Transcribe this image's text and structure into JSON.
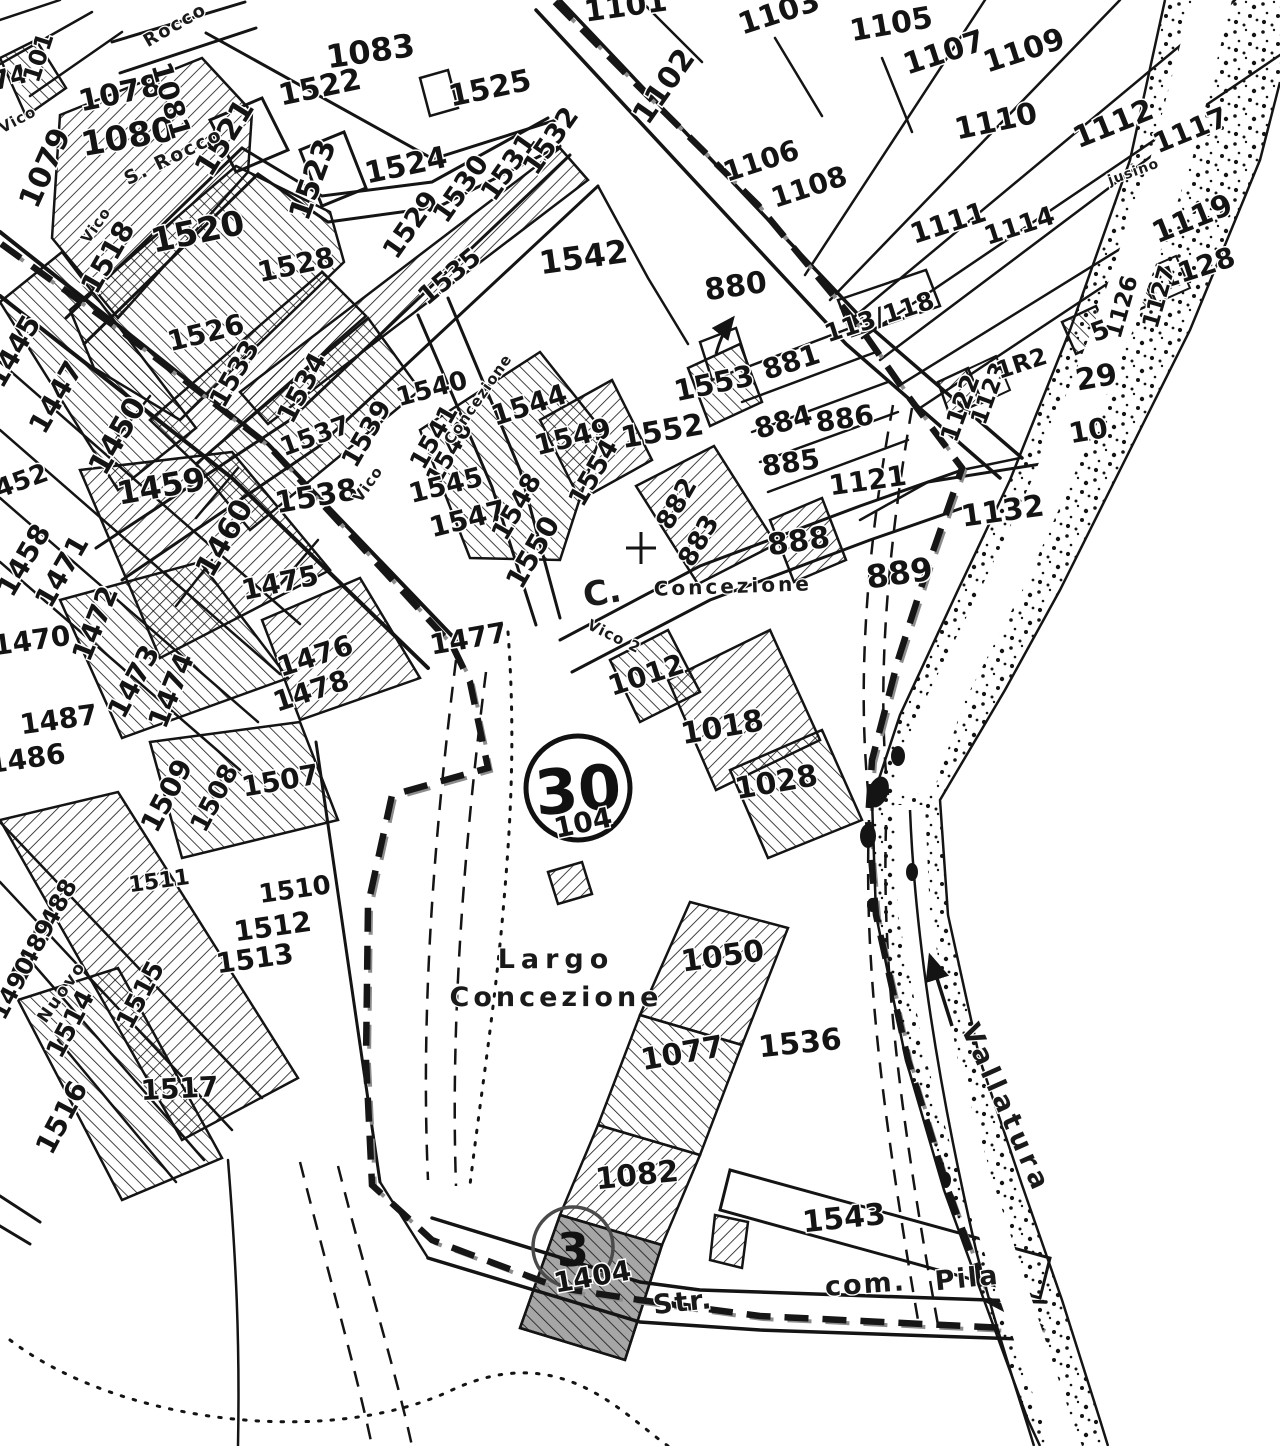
{
  "map": {
    "title": "Cadastral map sheet",
    "sheet": {
      "circle_number": "30",
      "sub_label": "104",
      "detail_circle_number": "3"
    },
    "colors": {
      "ink": "#141414",
      "paper": "#ffffff",
      "shade": "#a6a6a6",
      "scan_gray": "#8c8c8c"
    },
    "icons": [
      {
        "name": "flow-arrow-icon",
        "meaning": "stream flow direction"
      },
      {
        "name": "reference-arrow-icon",
        "meaning": "points label 880 to its parcel"
      },
      {
        "name": "church-cross-icon",
        "meaning": "church of the Concezione"
      }
    ],
    "parcel_labels": [
      {
        "t": "74",
        "x": 12,
        "y": 86,
        "r": -15,
        "s": 26
      },
      {
        "t": "101",
        "x": 46,
        "y": 60,
        "r": -72,
        "s": 24
      },
      {
        "t": "1079",
        "x": 54,
        "y": 172,
        "r": -66,
        "s": 30
      },
      {
        "t": "1078",
        "x": 122,
        "y": 103,
        "r": -12,
        "s": 30
      },
      {
        "t": "1080",
        "x": 130,
        "y": 148,
        "r": -10,
        "s": 34
      },
      {
        "t": "1081",
        "x": 162,
        "y": 103,
        "r": 74,
        "s": 28
      },
      {
        "t": "1083",
        "x": 372,
        "y": 62,
        "r": -8,
        "s": 32
      },
      {
        "t": "1522",
        "x": 322,
        "y": 97,
        "r": -12,
        "s": 30
      },
      {
        "t": "1525",
        "x": 492,
        "y": 98,
        "r": -12,
        "s": 30
      },
      {
        "t": "1521",
        "x": 233,
        "y": 143,
        "r": -58,
        "s": 30
      },
      {
        "t": "1523",
        "x": 322,
        "y": 183,
        "r": -70,
        "s": 30
      },
      {
        "t": "1524",
        "x": 408,
        "y": 175,
        "r": -12,
        "s": 30
      },
      {
        "t": "1520",
        "x": 200,
        "y": 243,
        "r": -12,
        "s": 34
      },
      {
        "t": "1518",
        "x": 116,
        "y": 262,
        "r": -60,
        "s": 28
      },
      {
        "t": "1528",
        "x": 298,
        "y": 274,
        "r": -12,
        "s": 28
      },
      {
        "t": "1529",
        "x": 418,
        "y": 230,
        "r": -55,
        "s": 27
      },
      {
        "t": "1530",
        "x": 468,
        "y": 194,
        "r": -55,
        "s": 27
      },
      {
        "t": "1531",
        "x": 516,
        "y": 172,
        "r": -55,
        "s": 27
      },
      {
        "t": "1532",
        "x": 558,
        "y": 146,
        "r": -55,
        "s": 27
      },
      {
        "t": "1535",
        "x": 455,
        "y": 283,
        "r": -40,
        "s": 26
      },
      {
        "t": "1526",
        "x": 208,
        "y": 342,
        "r": -14,
        "s": 28
      },
      {
        "t": "1533",
        "x": 242,
        "y": 378,
        "r": -60,
        "s": 26
      },
      {
        "t": "1534",
        "x": 310,
        "y": 392,
        "r": -62,
        "s": 27
      },
      {
        "t": "1537",
        "x": 318,
        "y": 444,
        "r": -20,
        "s": 26
      },
      {
        "t": "1539",
        "x": 374,
        "y": 438,
        "r": -60,
        "s": 26
      },
      {
        "t": "1540",
        "x": 434,
        "y": 397,
        "r": -15,
        "s": 26
      },
      {
        "t": "1541",
        "x": 441,
        "y": 441,
        "r": -60,
        "s": 25
      },
      {
        "t": "1538",
        "x": 318,
        "y": 506,
        "r": -10,
        "s": 30
      },
      {
        "t": "1542",
        "x": 585,
        "y": 268,
        "r": -8,
        "s": 32
      },
      {
        "t": "1544",
        "x": 532,
        "y": 414,
        "r": -18,
        "s": 28
      },
      {
        "t": "1546",
        "x": 456,
        "y": 457,
        "r": -60,
        "s": 24
      },
      {
        "t": "1545",
        "x": 448,
        "y": 494,
        "r": -14,
        "s": 27
      },
      {
        "t": "1547",
        "x": 470,
        "y": 528,
        "r": -14,
        "s": 28
      },
      {
        "t": "1548",
        "x": 524,
        "y": 511,
        "r": -60,
        "s": 26
      },
      {
        "t": "1550",
        "x": 541,
        "y": 557,
        "r": -60,
        "s": 28
      },
      {
        "t": "1549",
        "x": 575,
        "y": 446,
        "r": -14,
        "s": 28
      },
      {
        "t": "1554",
        "x": 601,
        "y": 477,
        "r": -60,
        "s": 26
      },
      {
        "t": "1552",
        "x": 664,
        "y": 441,
        "r": -10,
        "s": 30
      },
      {
        "t": "1553",
        "x": 716,
        "y": 393,
        "r": -12,
        "s": 29
      },
      {
        "t": "880",
        "x": 737,
        "y": 296,
        "r": -8,
        "s": 30
      },
      {
        "t": "881",
        "x": 794,
        "y": 371,
        "r": -18,
        "s": 28
      },
      {
        "t": "884",
        "x": 786,
        "y": 431,
        "r": -16,
        "s": 28
      },
      {
        "t": "885",
        "x": 792,
        "y": 472,
        "r": -8,
        "s": 28
      },
      {
        "t": "886",
        "x": 846,
        "y": 428,
        "r": -8,
        "s": 28
      },
      {
        "t": "882",
        "x": 684,
        "y": 508,
        "r": -60,
        "s": 26
      },
      {
        "t": "883",
        "x": 706,
        "y": 545,
        "r": -60,
        "s": 26
      },
      {
        "t": "888",
        "x": 800,
        "y": 551,
        "r": -8,
        "s": 30
      },
      {
        "t": "889",
        "x": 901,
        "y": 584,
        "r": -8,
        "s": 32
      },
      {
        "t": "1121",
        "x": 869,
        "y": 490,
        "r": -8,
        "s": 28
      },
      {
        "t": "1122",
        "x": 968,
        "y": 411,
        "r": -70,
        "s": 25
      },
      {
        "t": "1123",
        "x": 996,
        "y": 396,
        "r": -70,
        "s": 23
      },
      {
        "t": "1132",
        "x": 1004,
        "y": 521,
        "r": -8,
        "s": 30
      },
      {
        "t": "1101",
        "x": 627,
        "y": 16,
        "r": -8,
        "s": 30
      },
      {
        "t": "1102",
        "x": 672,
        "y": 92,
        "r": -55,
        "s": 30
      },
      {
        "t": "1103",
        "x": 782,
        "y": 22,
        "r": -18,
        "s": 30
      },
      {
        "t": "1105",
        "x": 893,
        "y": 34,
        "r": -10,
        "s": 30
      },
      {
        "t": "1106",
        "x": 764,
        "y": 170,
        "r": -18,
        "s": 28
      },
      {
        "t": "1108",
        "x": 812,
        "y": 196,
        "r": -18,
        "s": 28
      },
      {
        "t": "1107",
        "x": 947,
        "y": 62,
        "r": -18,
        "s": 30
      },
      {
        "t": "1109",
        "x": 1027,
        "y": 60,
        "r": -18,
        "s": 30
      },
      {
        "t": "1110",
        "x": 998,
        "y": 131,
        "r": -12,
        "s": 30
      },
      {
        "t": "1112",
        "x": 1117,
        "y": 133,
        "r": -22,
        "s": 30
      },
      {
        "t": "1117",
        "x": 1194,
        "y": 139,
        "r": -22,
        "s": 28
      },
      {
        "t": "1111",
        "x": 951,
        "y": 232,
        "r": -18,
        "s": 28
      },
      {
        "t": "1114",
        "x": 1022,
        "y": 234,
        "r": -18,
        "s": 26
      },
      {
        "t": "1119",
        "x": 1196,
        "y": 228,
        "r": -22,
        "s": 30
      },
      {
        "t": "1128",
        "x": 1200,
        "y": 277,
        "r": -18,
        "s": 28
      },
      {
        "t": "1126",
        "x": 1129,
        "y": 309,
        "r": -74,
        "s": 23
      },
      {
        "t": "1127",
        "x": 1166,
        "y": 299,
        "r": -74,
        "s": 23
      },
      {
        "t": "5",
        "x": 1103,
        "y": 339,
        "r": -20,
        "s": 26
      },
      {
        "t": "1R2",
        "x": 1024,
        "y": 371,
        "r": -18,
        "s": 24
      },
      {
        "t": "29",
        "x": 1098,
        "y": 387,
        "r": -10,
        "s": 30
      },
      {
        "t": "10",
        "x": 1090,
        "y": 440,
        "r": -10,
        "s": 28
      },
      {
        "t": "113/118",
        "x": 882,
        "y": 325,
        "r": -18,
        "s": 25
      },
      {
        "t": "1445",
        "x": 22,
        "y": 356,
        "r": -60,
        "s": 28
      },
      {
        "t": "1447",
        "x": 64,
        "y": 402,
        "r": -60,
        "s": 28
      },
      {
        "t": "1450",
        "x": 126,
        "y": 441,
        "r": -60,
        "s": 30
      },
      {
        "t": "1452",
        "x": 16,
        "y": 492,
        "r": -20,
        "s": 26
      },
      {
        "t": "1459",
        "x": 163,
        "y": 497,
        "r": -10,
        "s": 32
      },
      {
        "t": "1460",
        "x": 233,
        "y": 543,
        "r": -60,
        "s": 30
      },
      {
        "t": "1458",
        "x": 32,
        "y": 565,
        "r": -60,
        "s": 28
      },
      {
        "t": "1471",
        "x": 70,
        "y": 576,
        "r": -60,
        "s": 28
      },
      {
        "t": "1472",
        "x": 104,
        "y": 627,
        "r": -68,
        "s": 28
      },
      {
        "t": "1470",
        "x": 33,
        "y": 650,
        "r": -8,
        "s": 28
      },
      {
        "t": "1473",
        "x": 142,
        "y": 686,
        "r": -62,
        "s": 28
      },
      {
        "t": "1474",
        "x": 180,
        "y": 694,
        "r": -68,
        "s": 28
      },
      {
        "t": "1475",
        "x": 282,
        "y": 592,
        "r": -12,
        "s": 28
      },
      {
        "t": "1476",
        "x": 318,
        "y": 665,
        "r": -18,
        "s": 28
      },
      {
        "t": "1478",
        "x": 314,
        "y": 700,
        "r": -18,
        "s": 28
      },
      {
        "t": "1487",
        "x": 60,
        "y": 729,
        "r": -8,
        "s": 28
      },
      {
        "t": "1486",
        "x": 28,
        "y": 768,
        "r": -8,
        "s": 28
      },
      {
        "t": "1477",
        "x": 470,
        "y": 648,
        "r": -10,
        "s": 28
      },
      {
        "t": "1509",
        "x": 175,
        "y": 800,
        "r": -62,
        "s": 28
      },
      {
        "t": "1508",
        "x": 222,
        "y": 802,
        "r": -62,
        "s": 26
      },
      {
        "t": "1507",
        "x": 282,
        "y": 790,
        "r": -10,
        "s": 28
      },
      {
        "t": "1510",
        "x": 296,
        "y": 898,
        "r": -8,
        "s": 26
      },
      {
        "t": "1511",
        "x": 160,
        "y": 888,
        "r": -8,
        "s": 22
      },
      {
        "t": "1512",
        "x": 274,
        "y": 936,
        "r": -8,
        "s": 28
      },
      {
        "t": "1513",
        "x": 256,
        "y": 968,
        "r": -8,
        "s": 28
      },
      {
        "t": "1488",
        "x": 62,
        "y": 914,
        "r": -62,
        "s": 24
      },
      {
        "t": "1489",
        "x": 40,
        "y": 954,
        "r": -62,
        "s": 24
      },
      {
        "t": "1490",
        "x": 20,
        "y": 992,
        "r": -62,
        "s": 24
      },
      {
        "t": "1515",
        "x": 148,
        "y": 999,
        "r": -62,
        "s": 26
      },
      {
        "t": "1514",
        "x": 78,
        "y": 1028,
        "r": -62,
        "s": 26
      },
      {
        "t": "1516",
        "x": 70,
        "y": 1122,
        "r": -62,
        "s": 28
      },
      {
        "t": "1517",
        "x": 180,
        "y": 1098,
        "r": -3,
        "s": 28
      },
      {
        "t": "1012",
        "x": 649,
        "y": 684,
        "r": -18,
        "s": 28
      },
      {
        "t": "1018",
        "x": 724,
        "y": 737,
        "r": -10,
        "s": 30
      },
      {
        "t": "1028",
        "x": 778,
        "y": 792,
        "r": -10,
        "s": 30
      },
      {
        "t": "104",
        "x": 585,
        "y": 832,
        "r": -12,
        "s": 28
      },
      {
        "t": "1050",
        "x": 724,
        "y": 966,
        "r": -8,
        "s": 30
      },
      {
        "t": "1077",
        "x": 684,
        "y": 1063,
        "r": -10,
        "s": 30
      },
      {
        "t": "1536",
        "x": 801,
        "y": 1053,
        "r": -6,
        "s": 30
      },
      {
        "t": "1082",
        "x": 638,
        "y": 1185,
        "r": -6,
        "s": 30
      },
      {
        "t": "1404",
        "x": 594,
        "y": 1286,
        "r": -10,
        "s": 28
      },
      {
        "t": "1543",
        "x": 845,
        "y": 1228,
        "r": -6,
        "s": 30
      }
    ],
    "street_labels": [
      {
        "t": "Rocco",
        "x": 178,
        "y": 30,
        "r": -30,
        "s": 18,
        "sp": 2
      },
      {
        "t": "S. Rocco",
        "x": 176,
        "y": 162,
        "r": -26,
        "s": 19,
        "sp": 2
      },
      {
        "t": "Vico",
        "x": 20,
        "y": 124,
        "r": -28,
        "s": 15,
        "sp": 1
      },
      {
        "t": "Vico",
        "x": 100,
        "y": 228,
        "r": -55,
        "s": 15,
        "sp": 1
      },
      {
        "t": "Vico",
        "x": 372,
        "y": 487,
        "r": -55,
        "s": 15,
        "sp": 1
      },
      {
        "t": "Concezione",
        "x": 482,
        "y": 402,
        "r": -55,
        "s": 15,
        "sp": 1
      },
      {
        "t": "Concezione",
        "x": 733,
        "y": 593,
        "r": -2,
        "s": 20,
        "sp": 3
      },
      {
        "t": "C.",
        "x": 604,
        "y": 604,
        "r": -10,
        "s": 34,
        "sp": 0
      },
      {
        "t": "Vico 2",
        "x": 612,
        "y": 641,
        "r": 26,
        "s": 15,
        "sp": 1
      },
      {
        "t": "jusino",
        "x": 1135,
        "y": 176,
        "r": -20,
        "s": 14,
        "sp": 1
      },
      {
        "t": "Largo",
        "x": 556,
        "y": 968,
        "r": 0,
        "s": 27,
        "sp": 6
      },
      {
        "t": "Concezione",
        "x": 556,
        "y": 1006,
        "r": 0,
        "s": 27,
        "sp": 4
      },
      {
        "t": "Nuovo",
        "x": 66,
        "y": 995,
        "r": -55,
        "s": 17,
        "sp": 2
      },
      {
        "t": "Str.",
        "x": 684,
        "y": 1311,
        "r": -6,
        "s": 27,
        "sp": 2
      },
      {
        "t": "com.",
        "x": 866,
        "y": 1293,
        "r": -4,
        "s": 27,
        "sp": 2
      },
      {
        "t": "Pila",
        "x": 968,
        "y": 1287,
        "r": -6,
        "s": 27,
        "sp": 2
      },
      {
        "t": "Vallatura",
        "x": 998,
        "y": 1112,
        "r": 66,
        "s": 27,
        "sp": 5
      }
    ]
  }
}
